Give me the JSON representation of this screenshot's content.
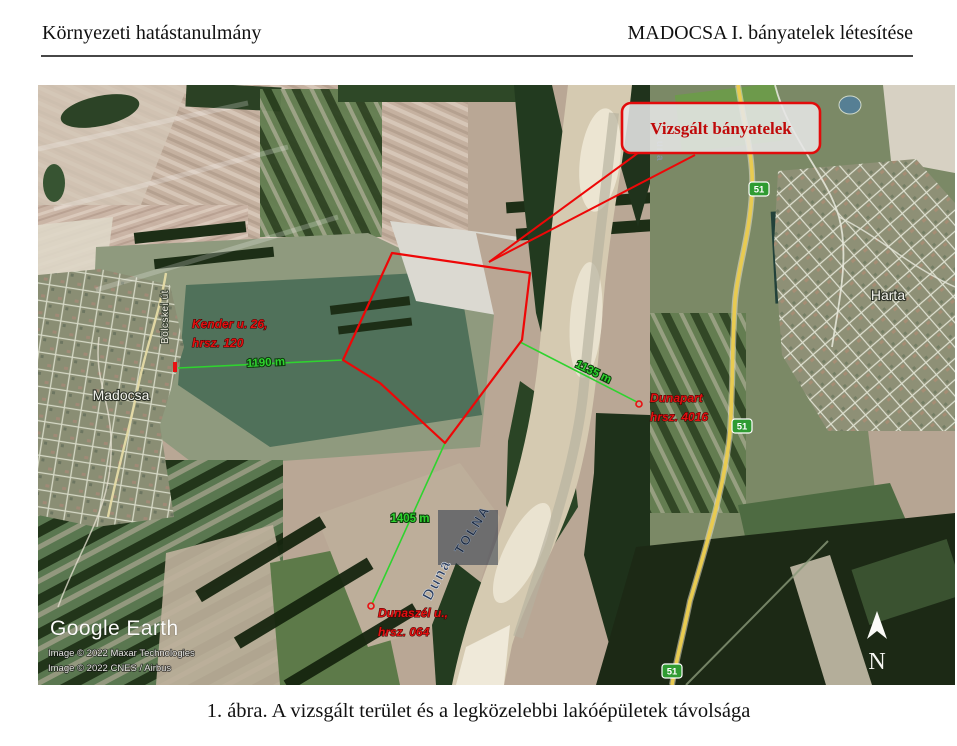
{
  "page": {
    "header_left": "Környezeti hatástanulmány",
    "header_right": "MADOCSA I. bányatelek létesítése",
    "caption": "1. ábra. A vizsgált terület és a legközelebbi lakóépületek távolsága"
  },
  "map": {
    "colors": {
      "annotation_red": "#e81111",
      "distance_green": "#2fd32f",
      "shield_green": "#2f9b32"
    },
    "callout": {
      "label": "Vizsgált bányatelek",
      "x": 584,
      "y": 18,
      "w": 198,
      "h": 50,
      "tip": [
        451,
        177
      ],
      "starts": [
        [
          600,
          68
        ],
        [
          657,
          70
        ]
      ]
    },
    "site_polygon": [
      [
        305,
        275
      ],
      [
        354,
        168
      ],
      [
        492,
        188
      ],
      [
        484,
        255
      ],
      [
        407,
        358
      ],
      [
        342,
        298
      ]
    ],
    "distance_lines": [
      {
        "label": "1190 m",
        "x1": 140,
        "y1": 283,
        "x2": 305,
        "y2": 275,
        "lx": 228,
        "ly": 281,
        "rot": -3,
        "marker": {
          "type": "bar",
          "x": 137,
          "y": 282
        }
      },
      {
        "label": "1135 m",
        "x1": 482,
        "y1": 257,
        "x2": 599,
        "y2": 317,
        "lx": 554,
        "ly": 290,
        "rot": 26,
        "marker": {
          "type": "ring",
          "x": 601,
          "y": 319
        }
      },
      {
        "label": "1405 m",
        "x1": 407,
        "y1": 358,
        "x2": 334,
        "y2": 519,
        "lx": 372,
        "ly": 437,
        "rot": 0,
        "marker": {
          "type": "ring",
          "x": 333,
          "y": 521
        }
      }
    ],
    "property_labels": [
      {
        "lines": [
          "Kender u. 26,",
          "hrsz. 120"
        ],
        "x": 154,
        "y": 243
      },
      {
        "lines": [
          "Dunapart",
          "hrsz. 4016"
        ],
        "x": 612,
        "y": 317
      },
      {
        "lines": [
          "Dunaszél u.,",
          "hrsz. 064"
        ],
        "x": 340,
        "y": 532
      }
    ],
    "place_labels": [
      {
        "text": "Madocsa",
        "x": 83,
        "y": 315,
        "rot": 0,
        "style": "town"
      },
      {
        "text": "Harta",
        "x": 850,
        "y": 215,
        "rot": 0,
        "style": "town"
      },
      {
        "text": "Bölcskei út",
        "x": 130,
        "y": 232,
        "rot": -90,
        "style": "road"
      },
      {
        "text": "Duna",
        "x": 619,
        "y": 62,
        "rot": 90,
        "style": "river-small"
      },
      {
        "text": "Duna",
        "x": 403,
        "y": 497,
        "rot": -62,
        "style": "river"
      },
      {
        "text": "TOLNA",
        "x": 438,
        "y": 447,
        "rot": -58,
        "style": "county"
      }
    ],
    "county_box": {
      "x": 400,
      "y": 425,
      "w": 60,
      "h": 55
    },
    "road_shields": [
      {
        "label": "51",
        "x": 721,
        "y": 104
      },
      {
        "label": "51",
        "x": 704,
        "y": 341
      },
      {
        "label": "51",
        "x": 634,
        "y": 586
      }
    ],
    "north": {
      "label": "N",
      "x": 839,
      "y": 584
    },
    "credits": {
      "logo": "Google Earth",
      "line1": "Image © 2022 Maxar Technologies",
      "line2": "Image © 2022 CNES / Airbus"
    }
  }
}
